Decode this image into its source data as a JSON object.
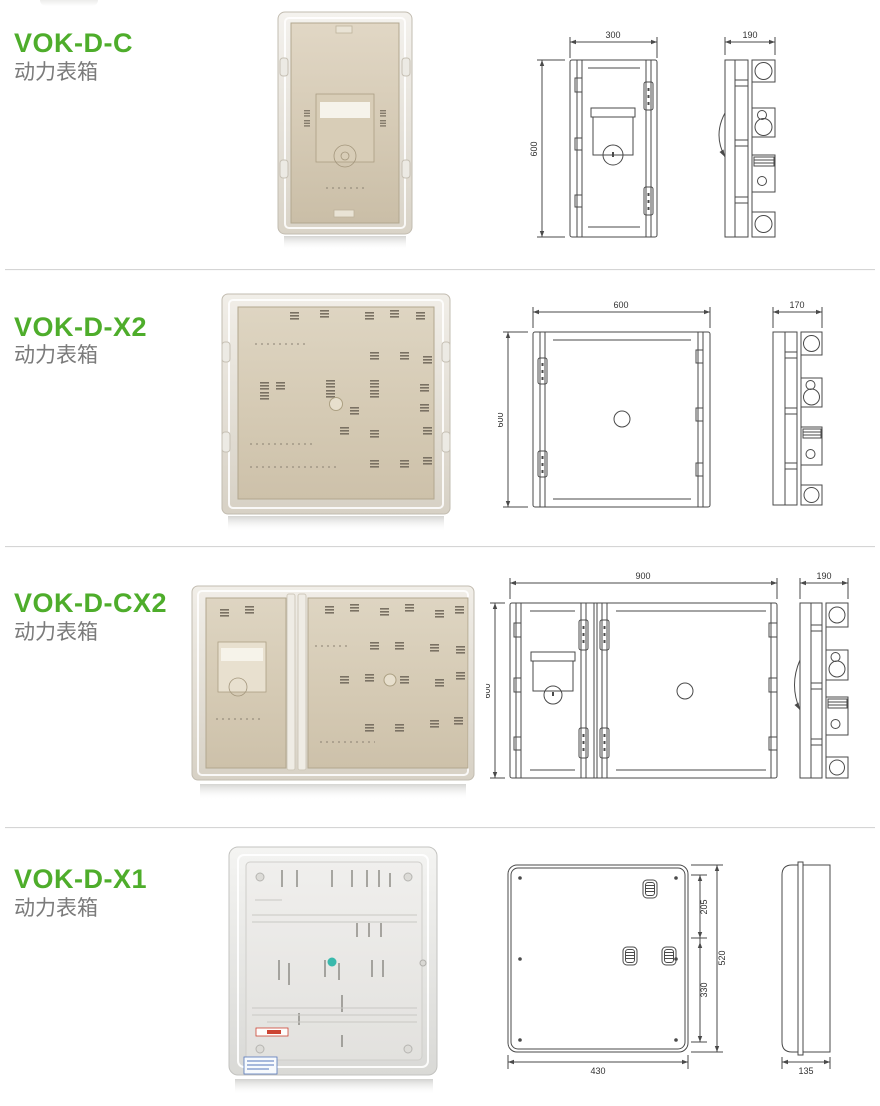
{
  "page": {
    "colors": {
      "accent-green": "#4ead2b",
      "subtitle-gray": "#7b7b7b",
      "line": "#4a4a4a",
      "divider": "#d5d5d5"
    }
  },
  "products": [
    {
      "model": "VOK-D-C",
      "category": "动力表箱",
      "front_view": {
        "width": "300",
        "height": "600"
      },
      "side_view": {
        "depth": "190"
      }
    },
    {
      "model": "VOK-D-X2",
      "category": "动力表箱",
      "front_view": {
        "width": "600",
        "height": "600"
      },
      "side_view": {
        "depth": "170"
      }
    },
    {
      "model": "VOK-D-CX2",
      "category": "动力表箱",
      "front_view": {
        "width": "900",
        "height": "600"
      },
      "side_view": {
        "depth": "190"
      }
    },
    {
      "model": "VOK-D-X1",
      "category": "动力表箱",
      "front_view": {
        "width": "430",
        "height": "520",
        "upper_offset": "205",
        "lower_offset": "330"
      },
      "side_view": {
        "depth": "135"
      }
    }
  ]
}
